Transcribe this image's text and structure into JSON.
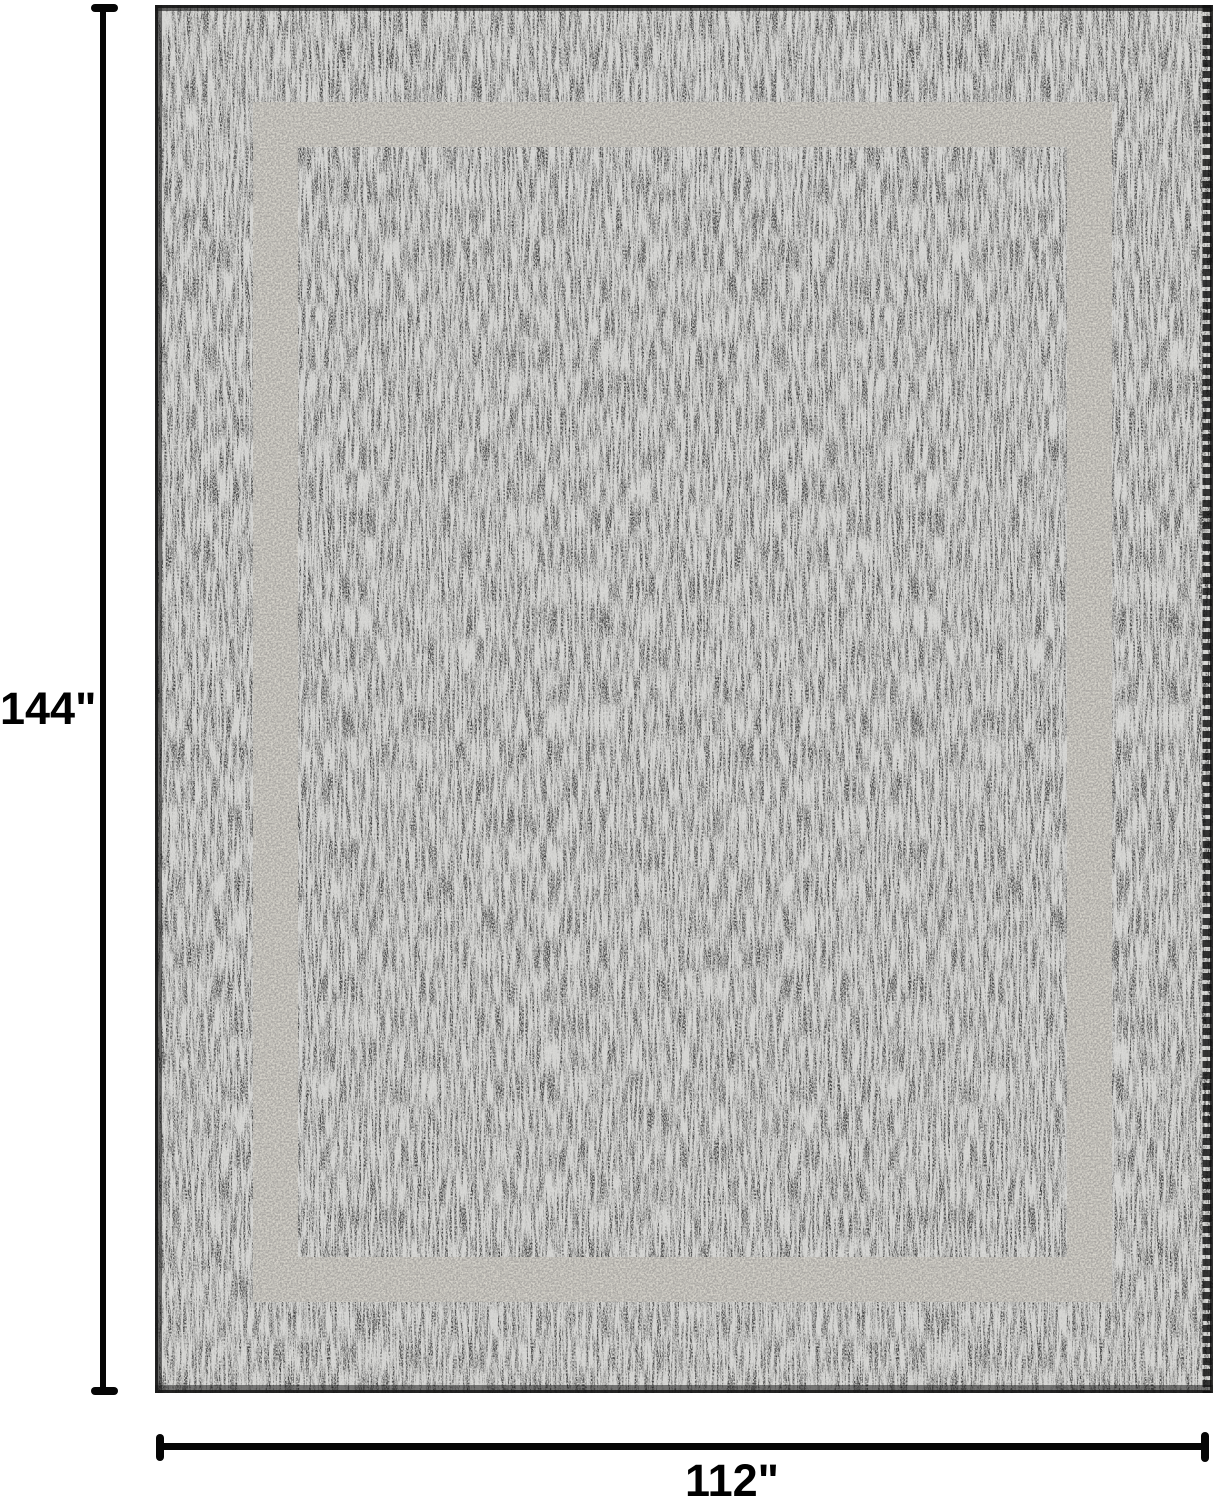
{
  "diagram": {
    "background_color": "#ffffff",
    "line_color": "#050505",
    "label_color": "#000000",
    "rug": {
      "description": "charcoal flatweave rug with light gray inset border band",
      "base_color": "#3f3f3f",
      "band_color": "#d6d3cb",
      "edge_color": "#141414"
    },
    "height_annotation": {
      "label": "144\""
    },
    "width_annotation": {
      "label": "112\""
    }
  }
}
